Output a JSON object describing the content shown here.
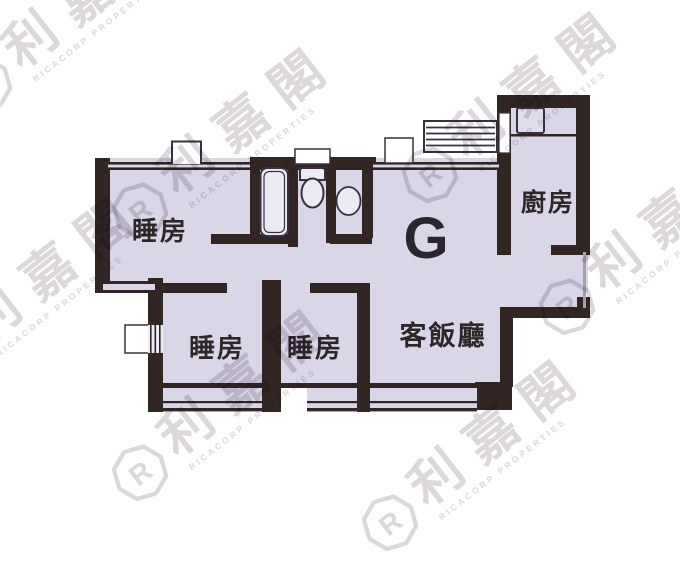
{
  "plan": {
    "unit_label": "G",
    "rooms": {
      "bedroom1": "睡房",
      "bedroom2": "睡房",
      "bedroom3": "睡房",
      "kitchen": "廚房",
      "living_dining": "客飯廳"
    },
    "watermark": {
      "cjk": "利嘉閣",
      "latin": "RICACORP PROPERTIES",
      "logo_letter": "R"
    },
    "colors": {
      "wall": "#312624",
      "floor": "#d9d6e8",
      "fixture_fill": "#eceaf4",
      "fixture_line": "#3a3140",
      "label": "#2e2629",
      "watermark": "#dcd7db",
      "thin_edge": "#a8a0b2"
    }
  }
}
